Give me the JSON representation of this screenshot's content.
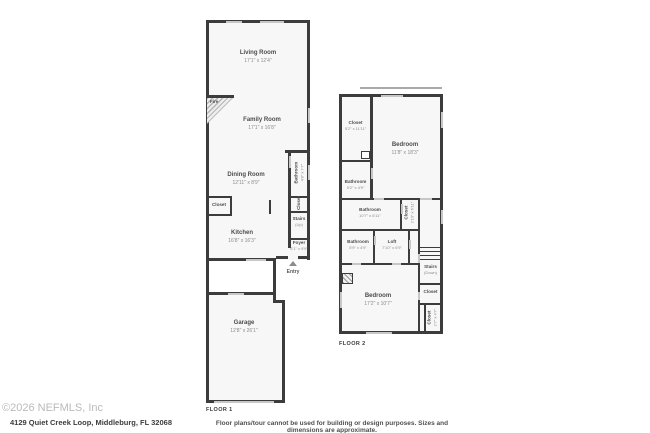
{
  "colors": {
    "wall": "#3c3c3c",
    "window": "#c7c7c7",
    "room_fill": "#f7f7f7"
  },
  "floor1": {
    "label": "FLOOR 1",
    "rooms": {
      "living": {
        "name": "Living Room",
        "dims": "17'1\" x 12'4\""
      },
      "family": {
        "name": "Family Room",
        "dims": "17'1\" x 16'8\""
      },
      "dining": {
        "name": "Dining Room",
        "dims": "12'11\" x 8'9\""
      },
      "bathroom": {
        "name": "Bathroom",
        "dims": "4'8\" x 7'7\""
      },
      "closet_right": {
        "name": "Closet"
      },
      "stairs": {
        "name": "Stairs",
        "sub": "(Up)"
      },
      "closet_left": {
        "name": "Closet"
      },
      "kitchen": {
        "name": "Kitchen",
        "dims": "16'8\" x 16'3\""
      },
      "foyer": {
        "name": "Foyer",
        "dims": "6'1\" x 9'9\""
      },
      "entry": {
        "name": "Entry"
      },
      "fire": {
        "name": "Fire"
      },
      "garage": {
        "name": "Garage",
        "dims": "12'8\" x 26'1\""
      }
    }
  },
  "floor2": {
    "label": "FLOOR 2",
    "rooms": {
      "closet_top": {
        "name": "Closet",
        "dims": "5'2\" x 11'11\""
      },
      "bedroom_top": {
        "name": "Bedroom",
        "dims": "11'8\" x 18'3\""
      },
      "bathroom_upper": {
        "name": "Bathroom",
        "dims": "5'2\" x 4'9\""
      },
      "bathroom_mid": {
        "name": "Bathroom",
        "dims": "10'7\" x 6'11\""
      },
      "closet_mid": {
        "name": "Closet",
        "dims": "2'10\" x 6'11\""
      },
      "bathroom_lower": {
        "name": "Bathroom",
        "dims": "5'9\" x 4'9\""
      },
      "loft": {
        "name": "Loft",
        "dims": "7'10\" x 6'9\""
      },
      "bedroom_bottom": {
        "name": "Bedroom",
        "dims": "17'2\" x 10'7\""
      },
      "stairs": {
        "name": "Stairs",
        "sub": "(Down)"
      },
      "closet_right1": {
        "name": "Closet"
      },
      "closet_right2": {
        "name": "Closet",
        "dims": "2'7\" x 4'7\""
      }
    }
  },
  "footer": {
    "copyright": "©2026 NEFMLS, Inc",
    "address": "4129 Quiet Creek Loop, Middleburg, FL 32068",
    "disclaimer": "Floor plans/tour cannot be used for building or design purposes. Sizes and dimensions are approximate."
  }
}
